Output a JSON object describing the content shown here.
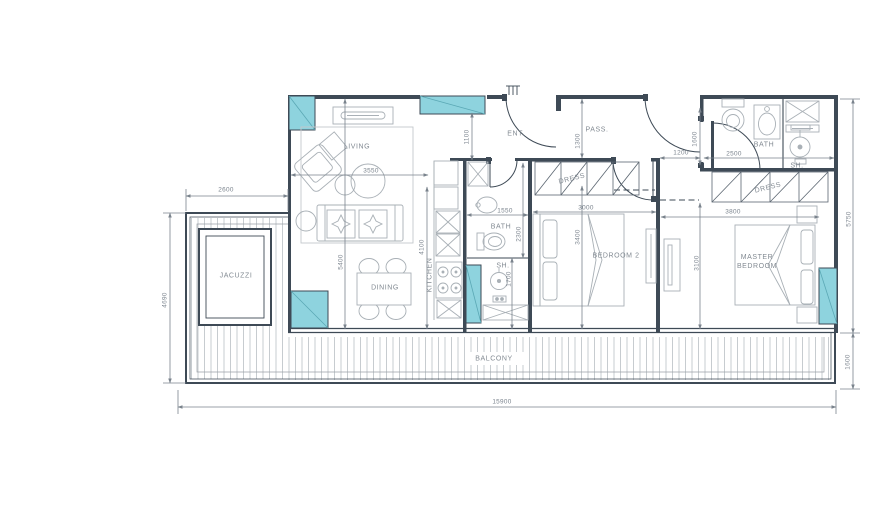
{
  "labels": {
    "jacuzzi": "JACUZZI",
    "living": "LIVING",
    "dining": "DINING",
    "kitchen": "KITCHEN",
    "bath_middle": "BATH",
    "shower_middle": "SH.",
    "entrance": "ENT.",
    "passage": "PASS.",
    "dress_bedroom2": "DRESS",
    "bedroom2": "BEDROOM 2",
    "master_bedroom": "MASTER BEDROOM",
    "bath_master": "BATH",
    "shower_master": "SH.",
    "dress_master": "DRESS",
    "balcony": "BALCONY"
  },
  "dims": {
    "d2600": "2600",
    "d4690": "4690",
    "d15900": "15900",
    "d5750": "5750",
    "d1600_balcony": "1600",
    "d3550": "3550",
    "d5400": "5400",
    "d4100": "4100",
    "d1100": "1100",
    "d1550": "1550",
    "d2300": "2300",
    "d1700": "1700",
    "d1300": "1300",
    "d3000": "3000",
    "d3400": "3400",
    "d1200": "1200",
    "d1600_door": "1600",
    "d2500": "2500",
    "d3800": "3800",
    "d3100": "3100"
  },
  "colors": {
    "column_fill": "#8ed3de",
    "wall": "#3e4a56",
    "furniture_line": "#a9b0b6",
    "dimension_line": "#7a838d",
    "deck_line": "#b9bfc4"
  }
}
